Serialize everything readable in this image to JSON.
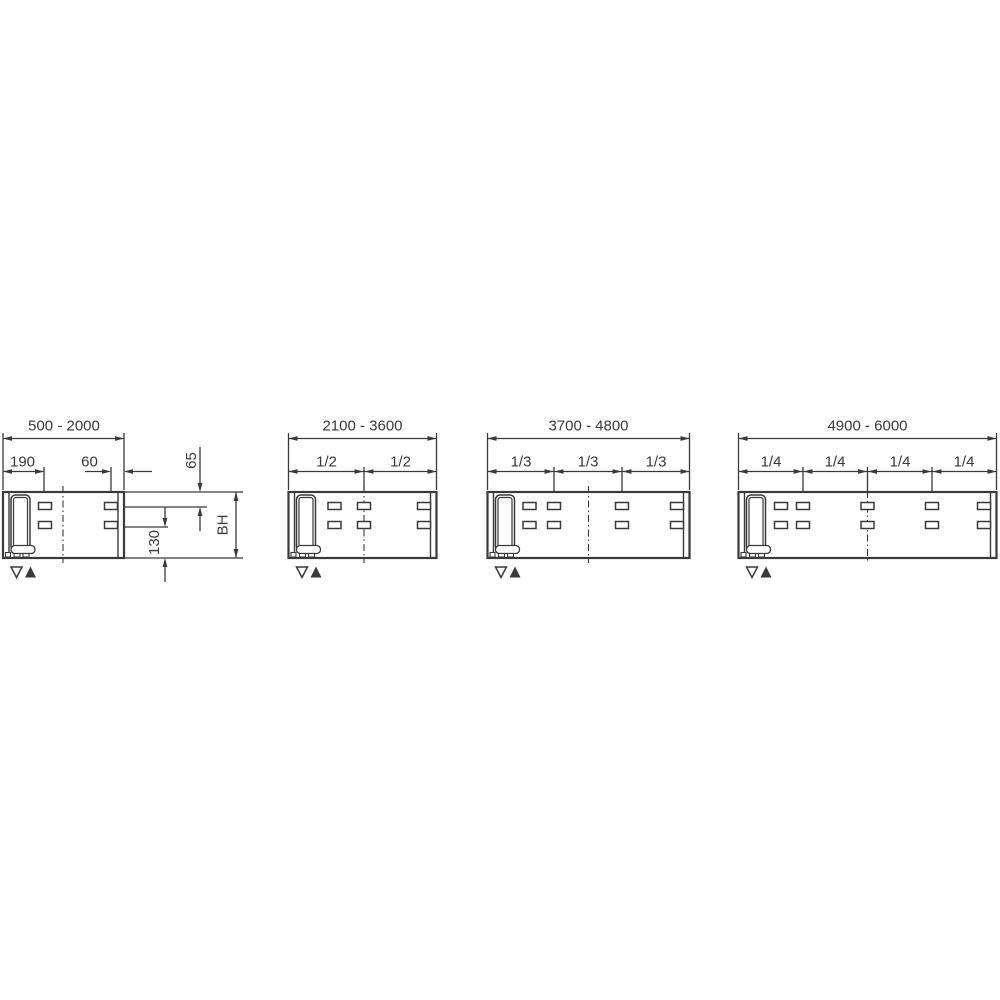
{
  "page": {
    "background_color": "#ffffff"
  },
  "drawing": {
    "line_color": "#3a3a3a",
    "text_color": "#3a3a3a",
    "figures": [
      {
        "range_label": "500 - 2000",
        "labels": {
          "left_slot_offset": "190",
          "right_slot_offset": "60",
          "top_slot_offset": "65",
          "bottom_slot_offset": "130",
          "body_height": "BH"
        },
        "markers": [
          "triangle-down-outline",
          "triangle-up-filled"
        ]
      },
      {
        "range_label": "2100 - 3600",
        "fractions": [
          "1/2",
          "1/2"
        ],
        "markers": [
          "triangle-down-outline",
          "triangle-up-filled"
        ]
      },
      {
        "range_label": "3700 - 4800",
        "fractions": [
          "1/3",
          "1/3",
          "1/3"
        ],
        "markers": [
          "triangle-down-outline",
          "triangle-up-filled"
        ]
      },
      {
        "range_label": "4900 - 6000",
        "fractions": [
          "1/4",
          "1/4",
          "1/4",
          "1/4"
        ],
        "markers": [
          "triangle-down-outline",
          "triangle-up-filled"
        ]
      }
    ]
  }
}
